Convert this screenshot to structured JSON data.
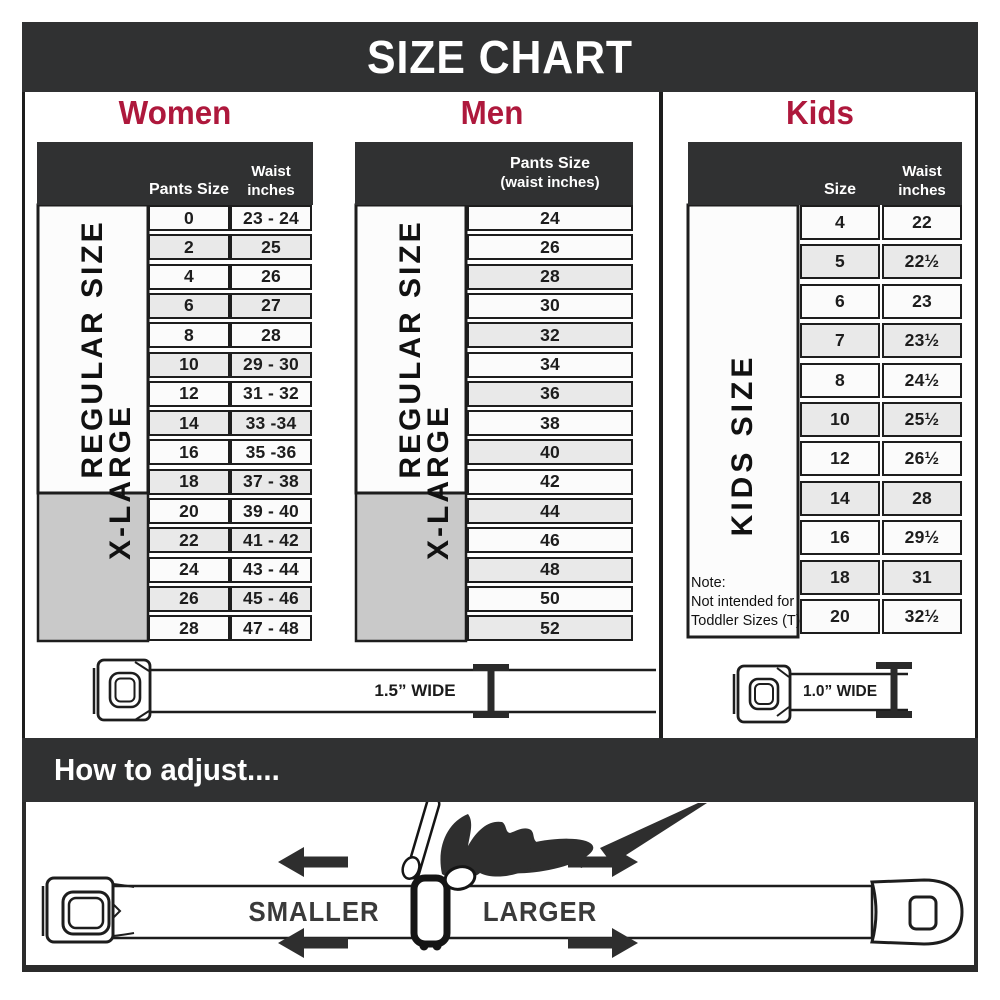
{
  "title": "SIZE CHART",
  "colors": {
    "banner_charcoal": "#303132",
    "accent_crimson": "#AE183C",
    "grid_black": "#1d1d1d",
    "xlarge_gray": "#C9C9C9",
    "row_light": "#FBFBFB",
    "row_alt": "#E9E9E9"
  },
  "sections": {
    "women": {
      "title": "Women",
      "col1_header": "Pants Size",
      "col2_header_line1": "Waist",
      "col2_header_line2": "inches",
      "regular_label": "REGULAR SIZE",
      "xlarge_label": "X-LARGE",
      "rows": [
        {
          "size": "0",
          "waist": "23 - 24"
        },
        {
          "size": "2",
          "waist": "25"
        },
        {
          "size": "4",
          "waist": "26"
        },
        {
          "size": "6",
          "waist": "27"
        },
        {
          "size": "8",
          "waist": "28"
        },
        {
          "size": "10",
          "waist": "29 - 30"
        },
        {
          "size": "12",
          "waist": "31 - 32"
        },
        {
          "size": "14",
          "waist": "33 -34"
        },
        {
          "size": "16",
          "waist": "35 -36"
        },
        {
          "size": "18",
          "waist": "37 - 38"
        },
        {
          "size": "20",
          "waist": "39 - 40"
        },
        {
          "size": "22",
          "waist": "41 - 42"
        },
        {
          "size": "24",
          "waist": "43 - 44"
        },
        {
          "size": "26",
          "waist": "45 - 46"
        },
        {
          "size": "28",
          "waist": "47 - 48"
        }
      ]
    },
    "men": {
      "title": "Men",
      "header_line1": "Pants Size",
      "header_line2": "(waist inches)",
      "regular_label": "REGULAR SIZE",
      "xlarge_label": "X-LARGE",
      "rows": [
        "24",
        "26",
        "28",
        "30",
        "32",
        "34",
        "36",
        "38",
        "40",
        "42",
        "44",
        "46",
        "48",
        "50",
        "52"
      ]
    },
    "kids": {
      "title": "Kids",
      "col1_header": "Size",
      "col2_header_line1": "Waist",
      "col2_header_line2": "inches",
      "side_label": "KIDS SIZE",
      "note_line1": "Note:",
      "note_line2": "Not intended for",
      "note_line3": "Toddler Sizes (T)",
      "rows": [
        {
          "size": "4",
          "waist": "22"
        },
        {
          "size": "5",
          "waist": "22½"
        },
        {
          "size": "6",
          "waist": "23"
        },
        {
          "size": "7",
          "waist": "23½"
        },
        {
          "size": "8",
          "waist": "24½"
        },
        {
          "size": "10",
          "waist": "25½"
        },
        {
          "size": "12",
          "waist": "26½"
        },
        {
          "size": "14",
          "waist": "28"
        },
        {
          "size": "16",
          "waist": "29½"
        },
        {
          "size": "18",
          "waist": "31"
        },
        {
          "size": "20",
          "waist": "32½"
        }
      ]
    }
  },
  "belts": {
    "adult_width_label": "1.5” WIDE",
    "kids_width_label": "1.0” WIDE"
  },
  "how_to_adjust": {
    "title": "How to adjust....",
    "smaller_label": "SMALLER",
    "larger_label": "LARGER"
  }
}
